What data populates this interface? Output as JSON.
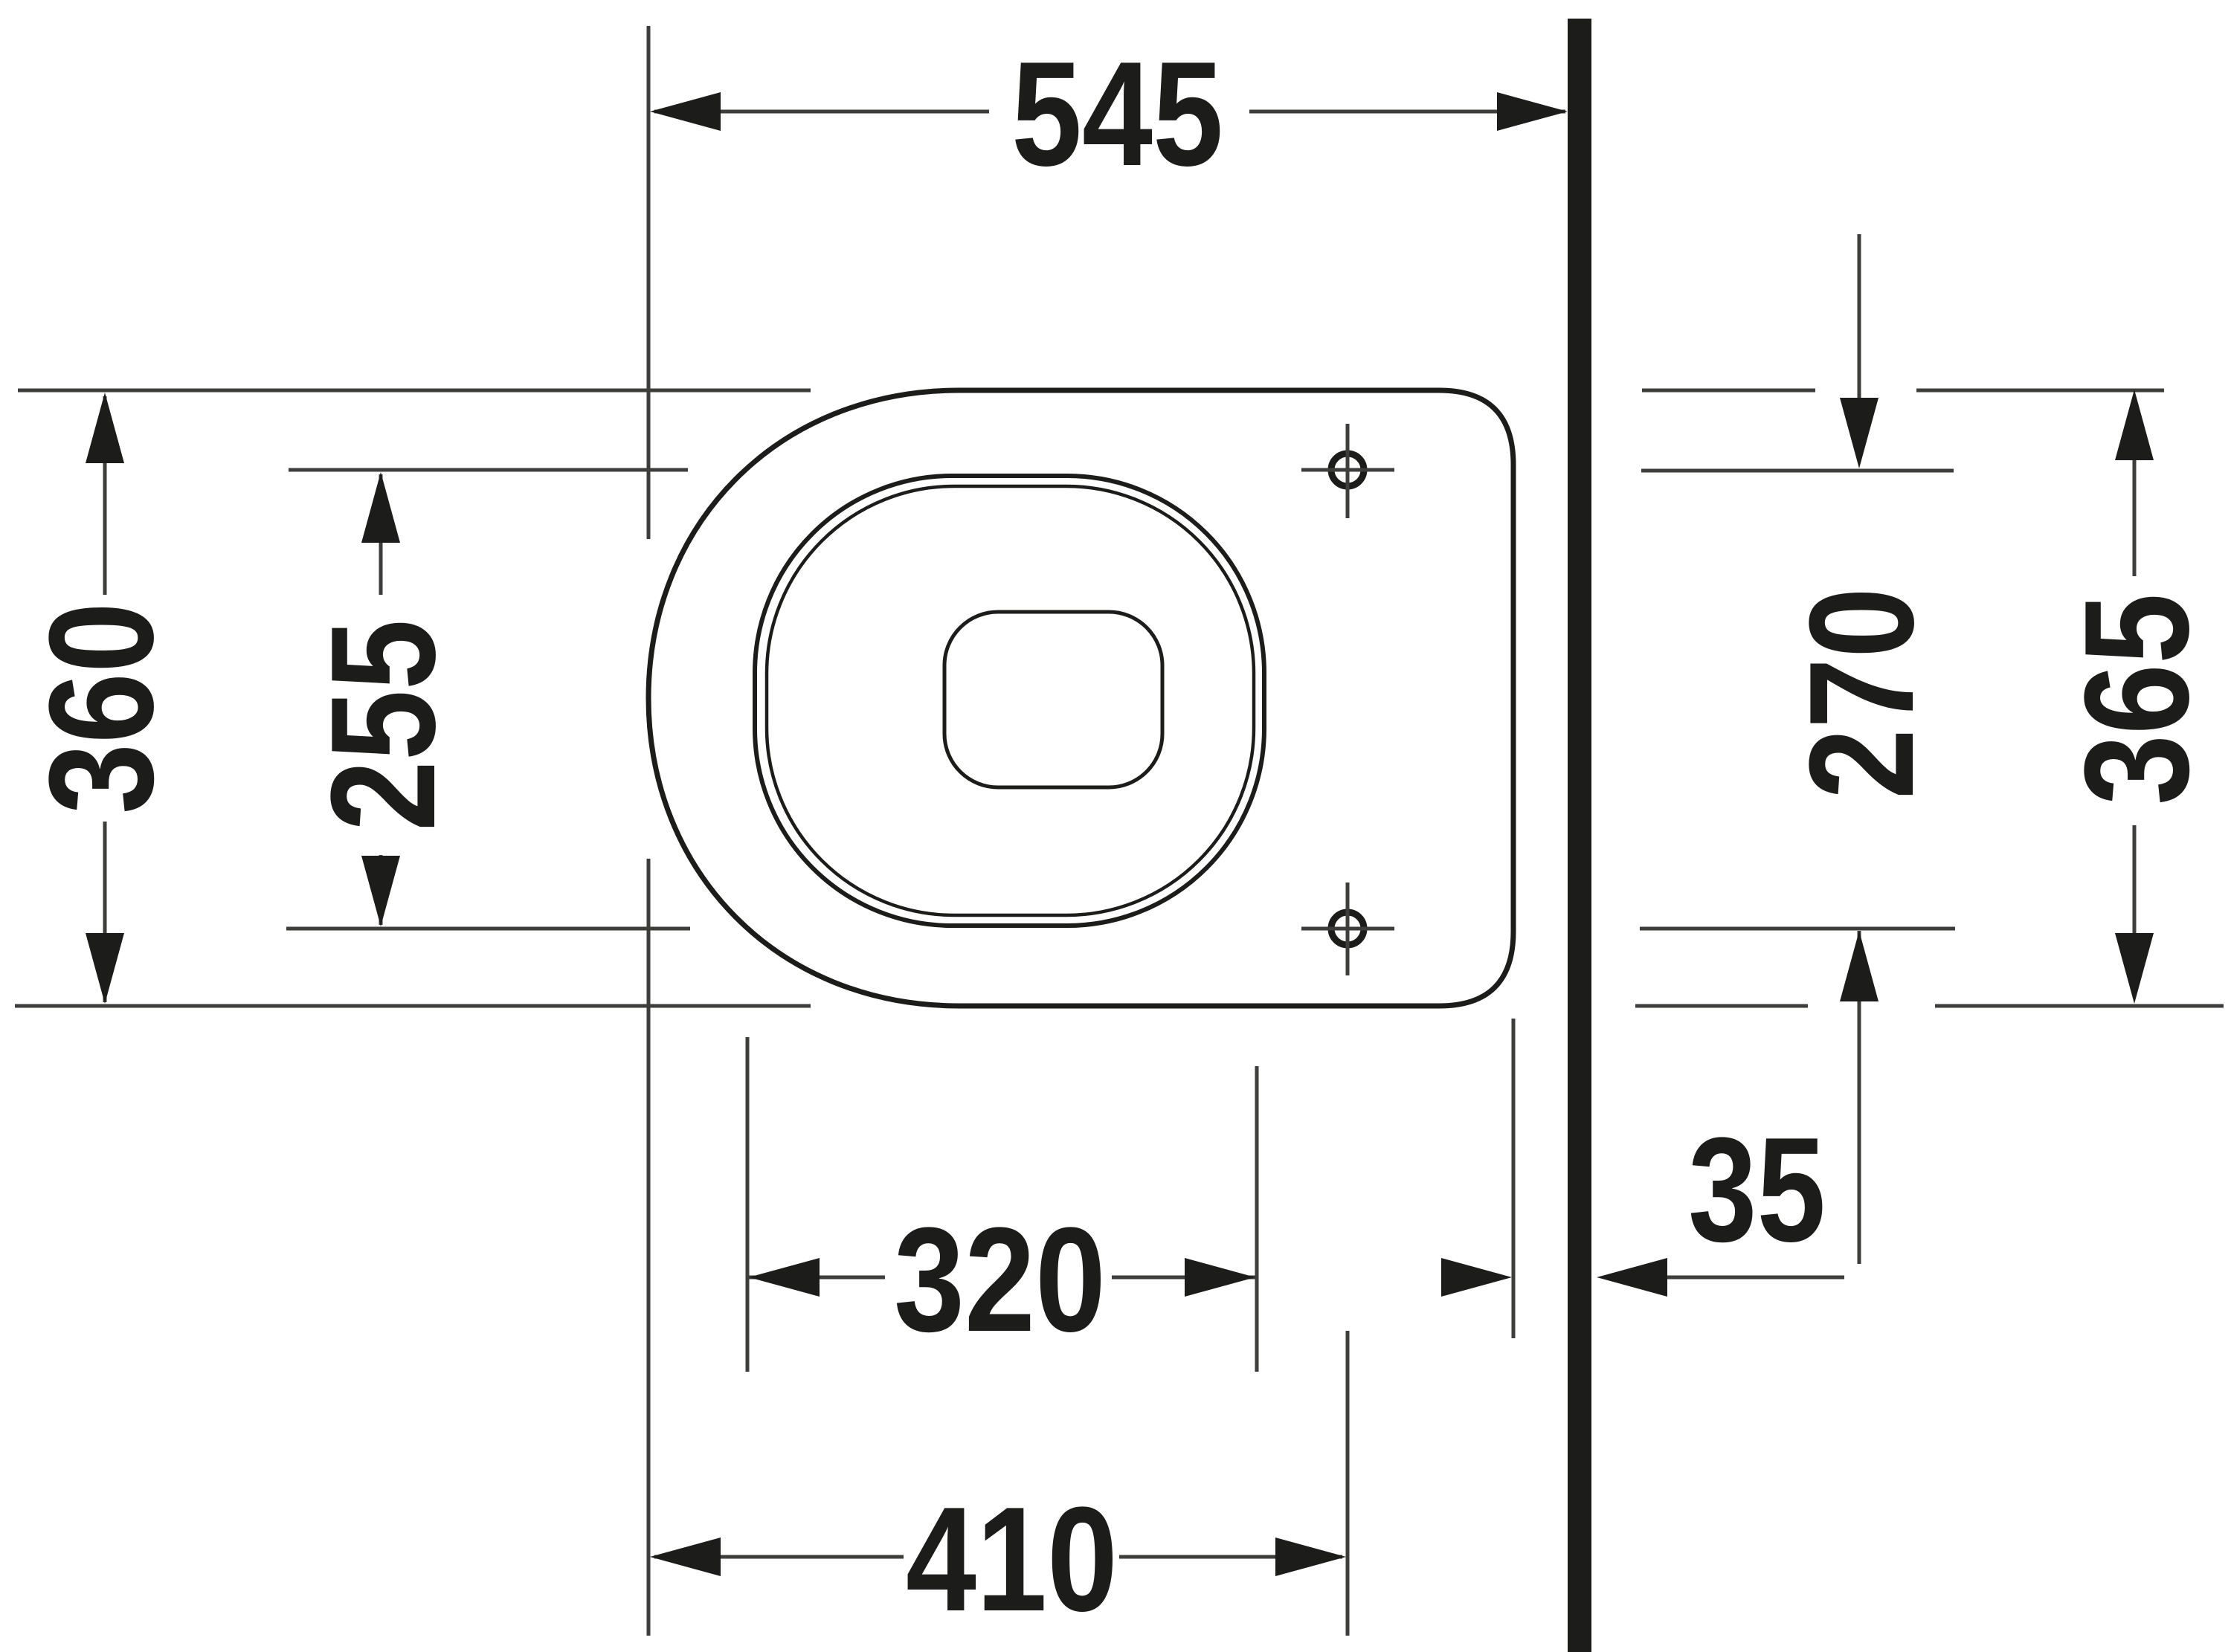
{
  "dims": {
    "depth_to_wall": "545",
    "outer_width": "360",
    "inner_width": "255",
    "fixing_hole_spacing": "270",
    "rear_width": "365",
    "wall_offset": "35",
    "hole_line_offset": "320",
    "outlet_distance": "410"
  },
  "colors": {
    "ink": "#1c1c1a",
    "thin_line": "#3d3d3b",
    "background": "#ffffff"
  }
}
